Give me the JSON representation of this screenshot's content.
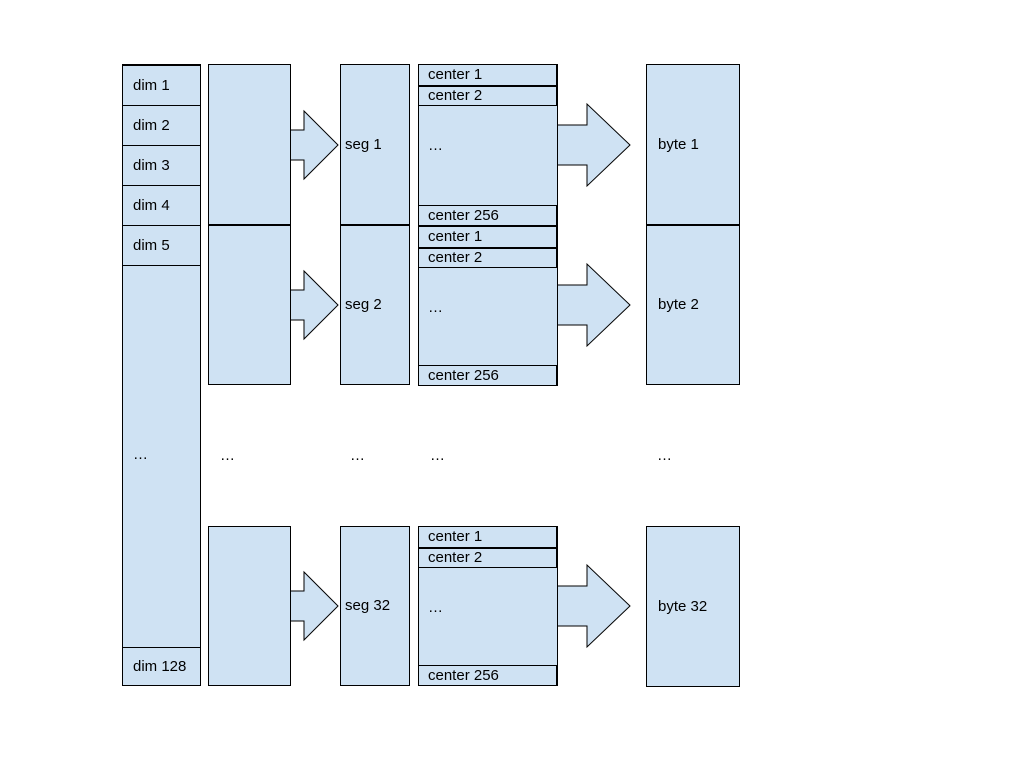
{
  "diagram": {
    "colors": {
      "box_fill": "#cfe2f3",
      "box_border": "#000000",
      "text": "#000000",
      "background": "#ffffff"
    },
    "dim_column": {
      "cells": [
        "dim 1",
        "dim 2",
        "dim 3",
        "dim 4",
        "dim 5"
      ],
      "ellipsis": "…",
      "last_cell": "dim 128"
    },
    "ellipsis_row": {
      "group": "…",
      "seg": "…",
      "center": "…",
      "byte": "…"
    },
    "rows": [
      {
        "seg_label": "seg 1",
        "byte_label": "byte 1",
        "centers": {
          "cell_1": "center 1",
          "cell_2": "center 2",
          "ellipsis": "…",
          "cell_last": "center 256"
        }
      },
      {
        "seg_label": "seg 2",
        "byte_label": "byte 2",
        "centers": {
          "cell_1": "center 1",
          "cell_2": "center 2",
          "ellipsis": "…",
          "cell_last": "center 256"
        }
      },
      {
        "seg_label": "seg 32",
        "byte_label": "byte 32",
        "centers": {
          "cell_1": "center 1",
          "cell_2": "center 2",
          "ellipsis": "…",
          "cell_last": "center 256"
        }
      }
    ]
  }
}
